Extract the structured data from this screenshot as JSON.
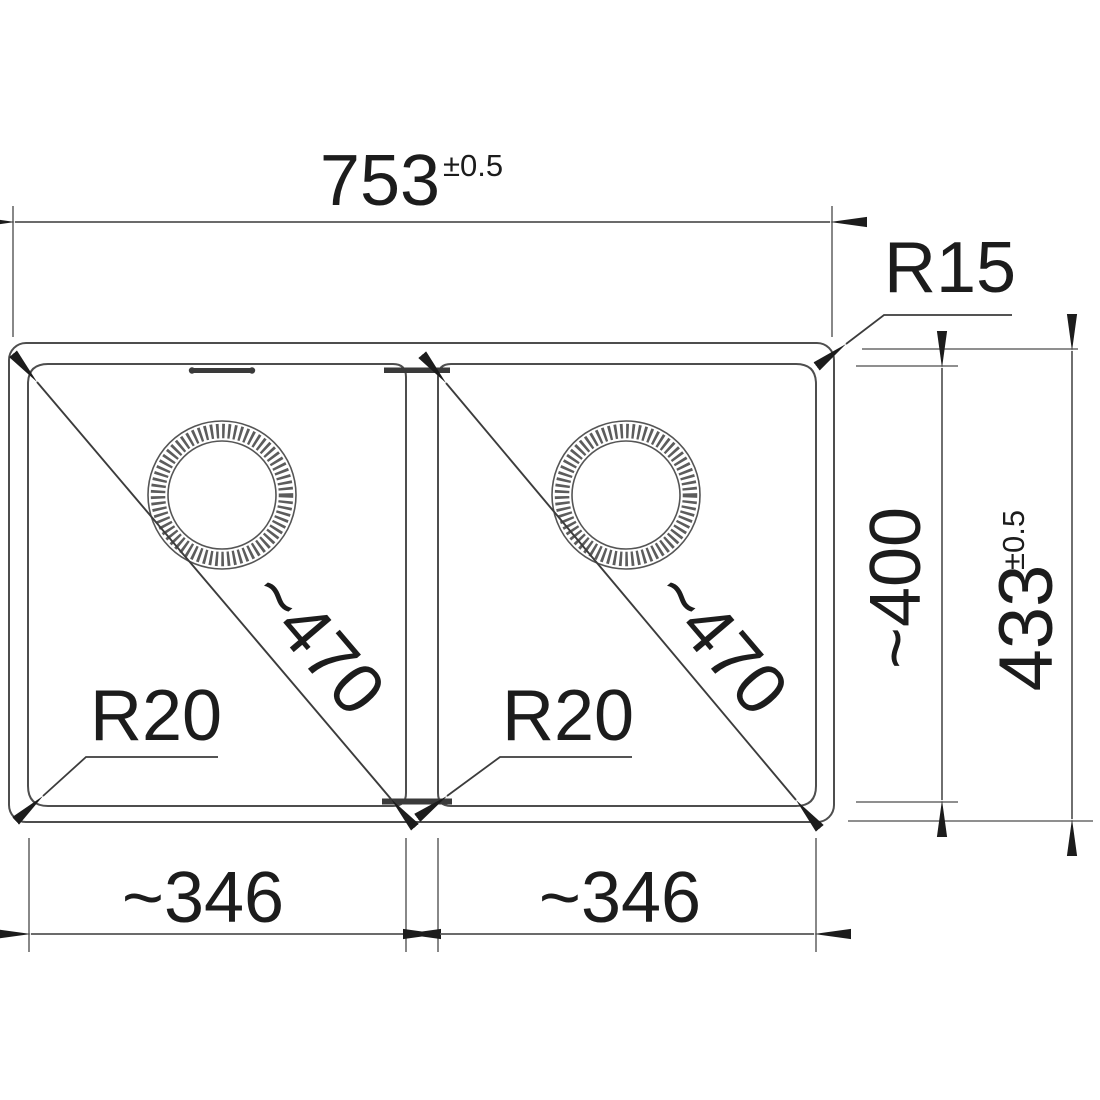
{
  "colors": {
    "background": "#ffffff",
    "line": "#565656",
    "ink": "#1c1c1c"
  },
  "dimensions": {
    "overall_width": {
      "value": "753",
      "tolerance": "±0.5"
    },
    "overall_depth": {
      "value": "433",
      "tolerance": "±0.5"
    },
    "bowl_depth": "~400",
    "bowl_width_left": "~346",
    "bowl_width_right": "~346",
    "bowl_diagonal_left": "~470",
    "bowl_diagonal_right": "~470",
    "outer_corner_radius": "R15",
    "inner_corner_radius_left": "R20",
    "inner_corner_radius_right": "R20"
  }
}
